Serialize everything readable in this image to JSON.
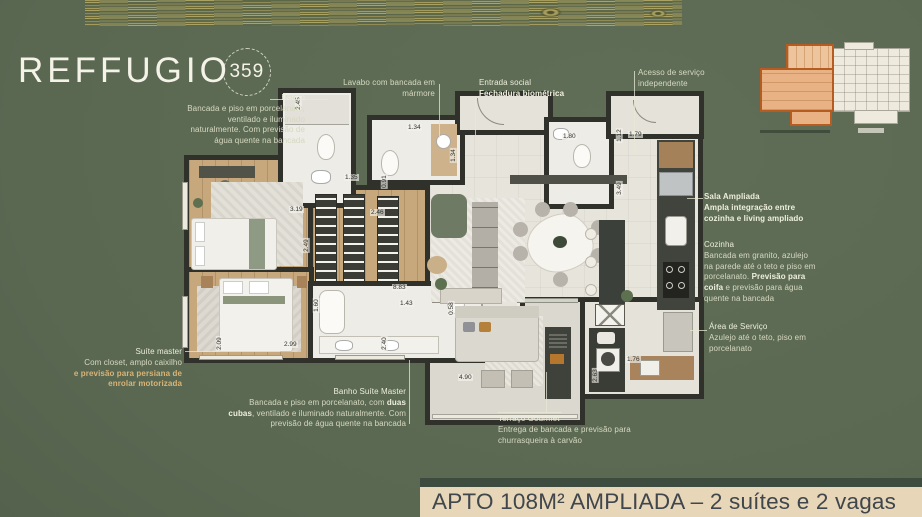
{
  "logo": {
    "brand": "REFFUGIO",
    "number": "359"
  },
  "title_bar": {
    "text": "APTO 108M² AMPLIADA – 2 suítes e 2 vagas"
  },
  "annotations": {
    "banho": {
      "title": "Banho",
      "body": "Bancada e piso em porcelanato, ventilado e iluminado naturalmente. Com previsão de água quente na bancada"
    },
    "lavabo": {
      "body": "Lavabo com bancada em mármore"
    },
    "entrada_social": {
      "title": "Entrada social",
      "body": "Fechadura biométrica"
    },
    "acesso_servico": {
      "body": "Acesso de serviço independente"
    },
    "sala_ampliada": {
      "title": "Sala Ampliada",
      "body": "Ampla integração entre cozinha e living ampliado"
    },
    "cozinha": {
      "title": "Cozinha",
      "body_pre": "Bancada em granito, azulejo na parede até o teto e piso em porcelanato. ",
      "body_bold": "Previsão para coifa",
      "body_post": " e previsão para água quente na bancada"
    },
    "area_servico": {
      "title": "Área de Serviço",
      "body": "Azulejo até o teto, piso em porcelanato"
    },
    "suite_master": {
      "title": "Suíte master",
      "body": "Com closet, amplo caixilho",
      "highlight": "e previsão para persiana de enrolar motorizada"
    },
    "banho_master": {
      "title": "Banho Suíte Master",
      "body_pre": "Bancada e piso em porcelanato, com ",
      "body_bold": "duas cubas",
      "body_post": ", ventilado e iluminado naturalmente. Com previsão de água quente na bancada"
    },
    "terraco": {
      "title": "Terraço Gourmet",
      "body": "Entrega de bancada e previsão para churrasqueira à carvão"
    }
  },
  "dimensions": [
    {
      "t": "2.45",
      "x": 291,
      "y": 100,
      "v": 1
    },
    {
      "t": "1.35",
      "x": 344,
      "y": 174
    },
    {
      "t": "1.34",
      "x": 407,
      "y": 124
    },
    {
      "t": "1.34",
      "x": 446,
      "y": 152,
      "v": 1
    },
    {
      "t": "1.80",
      "x": 562,
      "y": 133
    },
    {
      "t": "1.12",
      "x": 612,
      "y": 132,
      "v": 1
    },
    {
      "t": "1.79",
      "x": 628,
      "y": 131
    },
    {
      "t": "3.49",
      "x": 612,
      "y": 185,
      "v": 1
    },
    {
      "t": "0.91",
      "x": 377,
      "y": 178,
      "v": 1
    },
    {
      "t": "3.19",
      "x": 289,
      "y": 206
    },
    {
      "t": "2.46",
      "x": 370,
      "y": 209
    },
    {
      "t": "2.49",
      "x": 299,
      "y": 242,
      "v": 1
    },
    {
      "t": "8.83",
      "x": 392,
      "y": 284
    },
    {
      "t": "1.43",
      "x": 399,
      "y": 300
    },
    {
      "t": "1.60",
      "x": 309,
      "y": 302,
      "v": 1
    },
    {
      "t": "2.40",
      "x": 377,
      "y": 340,
      "v": 1
    },
    {
      "t": "2.09",
      "x": 212,
      "y": 340,
      "v": 1
    },
    {
      "t": "2.99",
      "x": 283,
      "y": 341
    },
    {
      "t": "0.58",
      "x": 444,
      "y": 305,
      "v": 1
    },
    {
      "t": "4.90",
      "x": 458,
      "y": 374
    },
    {
      "t": "2.63",
      "x": 588,
      "y": 372,
      "v": 1
    },
    {
      "t": "1.76",
      "x": 626,
      "y": 356
    }
  ],
  "palette": {
    "background": "#5a6852",
    "walls": "#30312b",
    "wood_floor": "#c7a77c",
    "annotation_text": "#d7d8c1",
    "accent_tan": "#d8b478",
    "title_bar_bg": "#e8d6b8",
    "title_text": "#3f464c",
    "keyplan_highlight": "#b65c20"
  }
}
